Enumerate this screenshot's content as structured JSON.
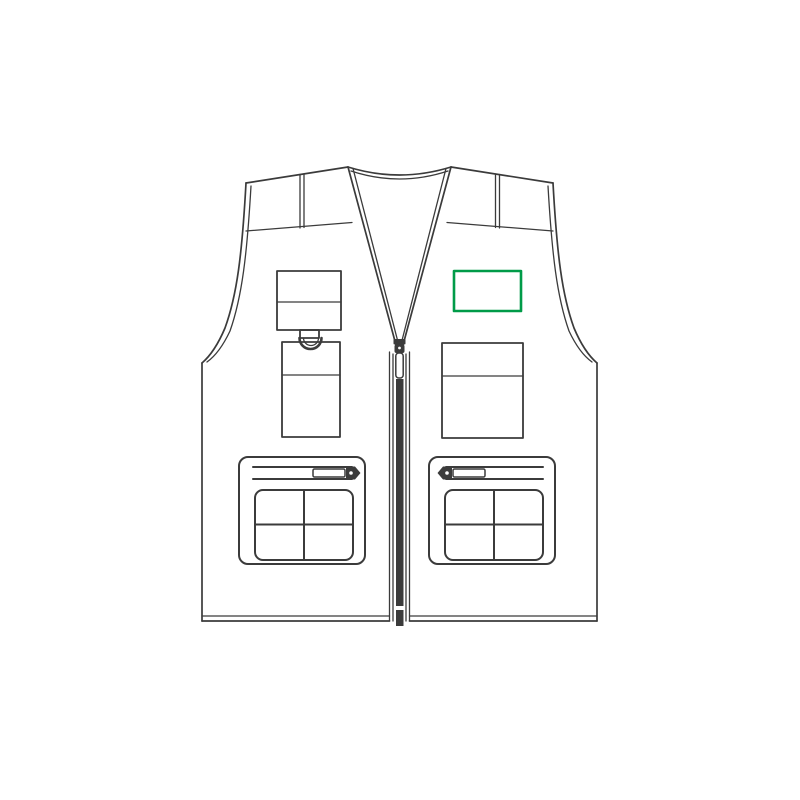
{
  "canvas": {
    "width": 800,
    "height": 800,
    "background": "#ffffff"
  },
  "artwork": {
    "description": "Front-view technical line drawing of a sleeveless multi-pocket zip vest (gilet)",
    "line_color": "#3b3b3b",
    "garment_fill": "#ffffff",
    "parts": [
      "collar-binding",
      "left-shoulder-strap",
      "right-shoulder-strap",
      "yoke-seams",
      "armhole-bindings",
      "front-zipper",
      "left-chest-flap-pocket",
      "d-ring-loop",
      "left-chest-patch-pocket",
      "right-chest-patch-pocket",
      "left-lower-cargo-pocket-with-zip",
      "right-lower-cargo-pocket-with-zip",
      "bottom-hem"
    ]
  },
  "print_area": {
    "label": "print-position-right-chest",
    "shape": "rectangle",
    "color": "#009b48",
    "x": 454,
    "y": 271,
    "width": 67,
    "height": 40,
    "stroke_width": 2.6
  }
}
